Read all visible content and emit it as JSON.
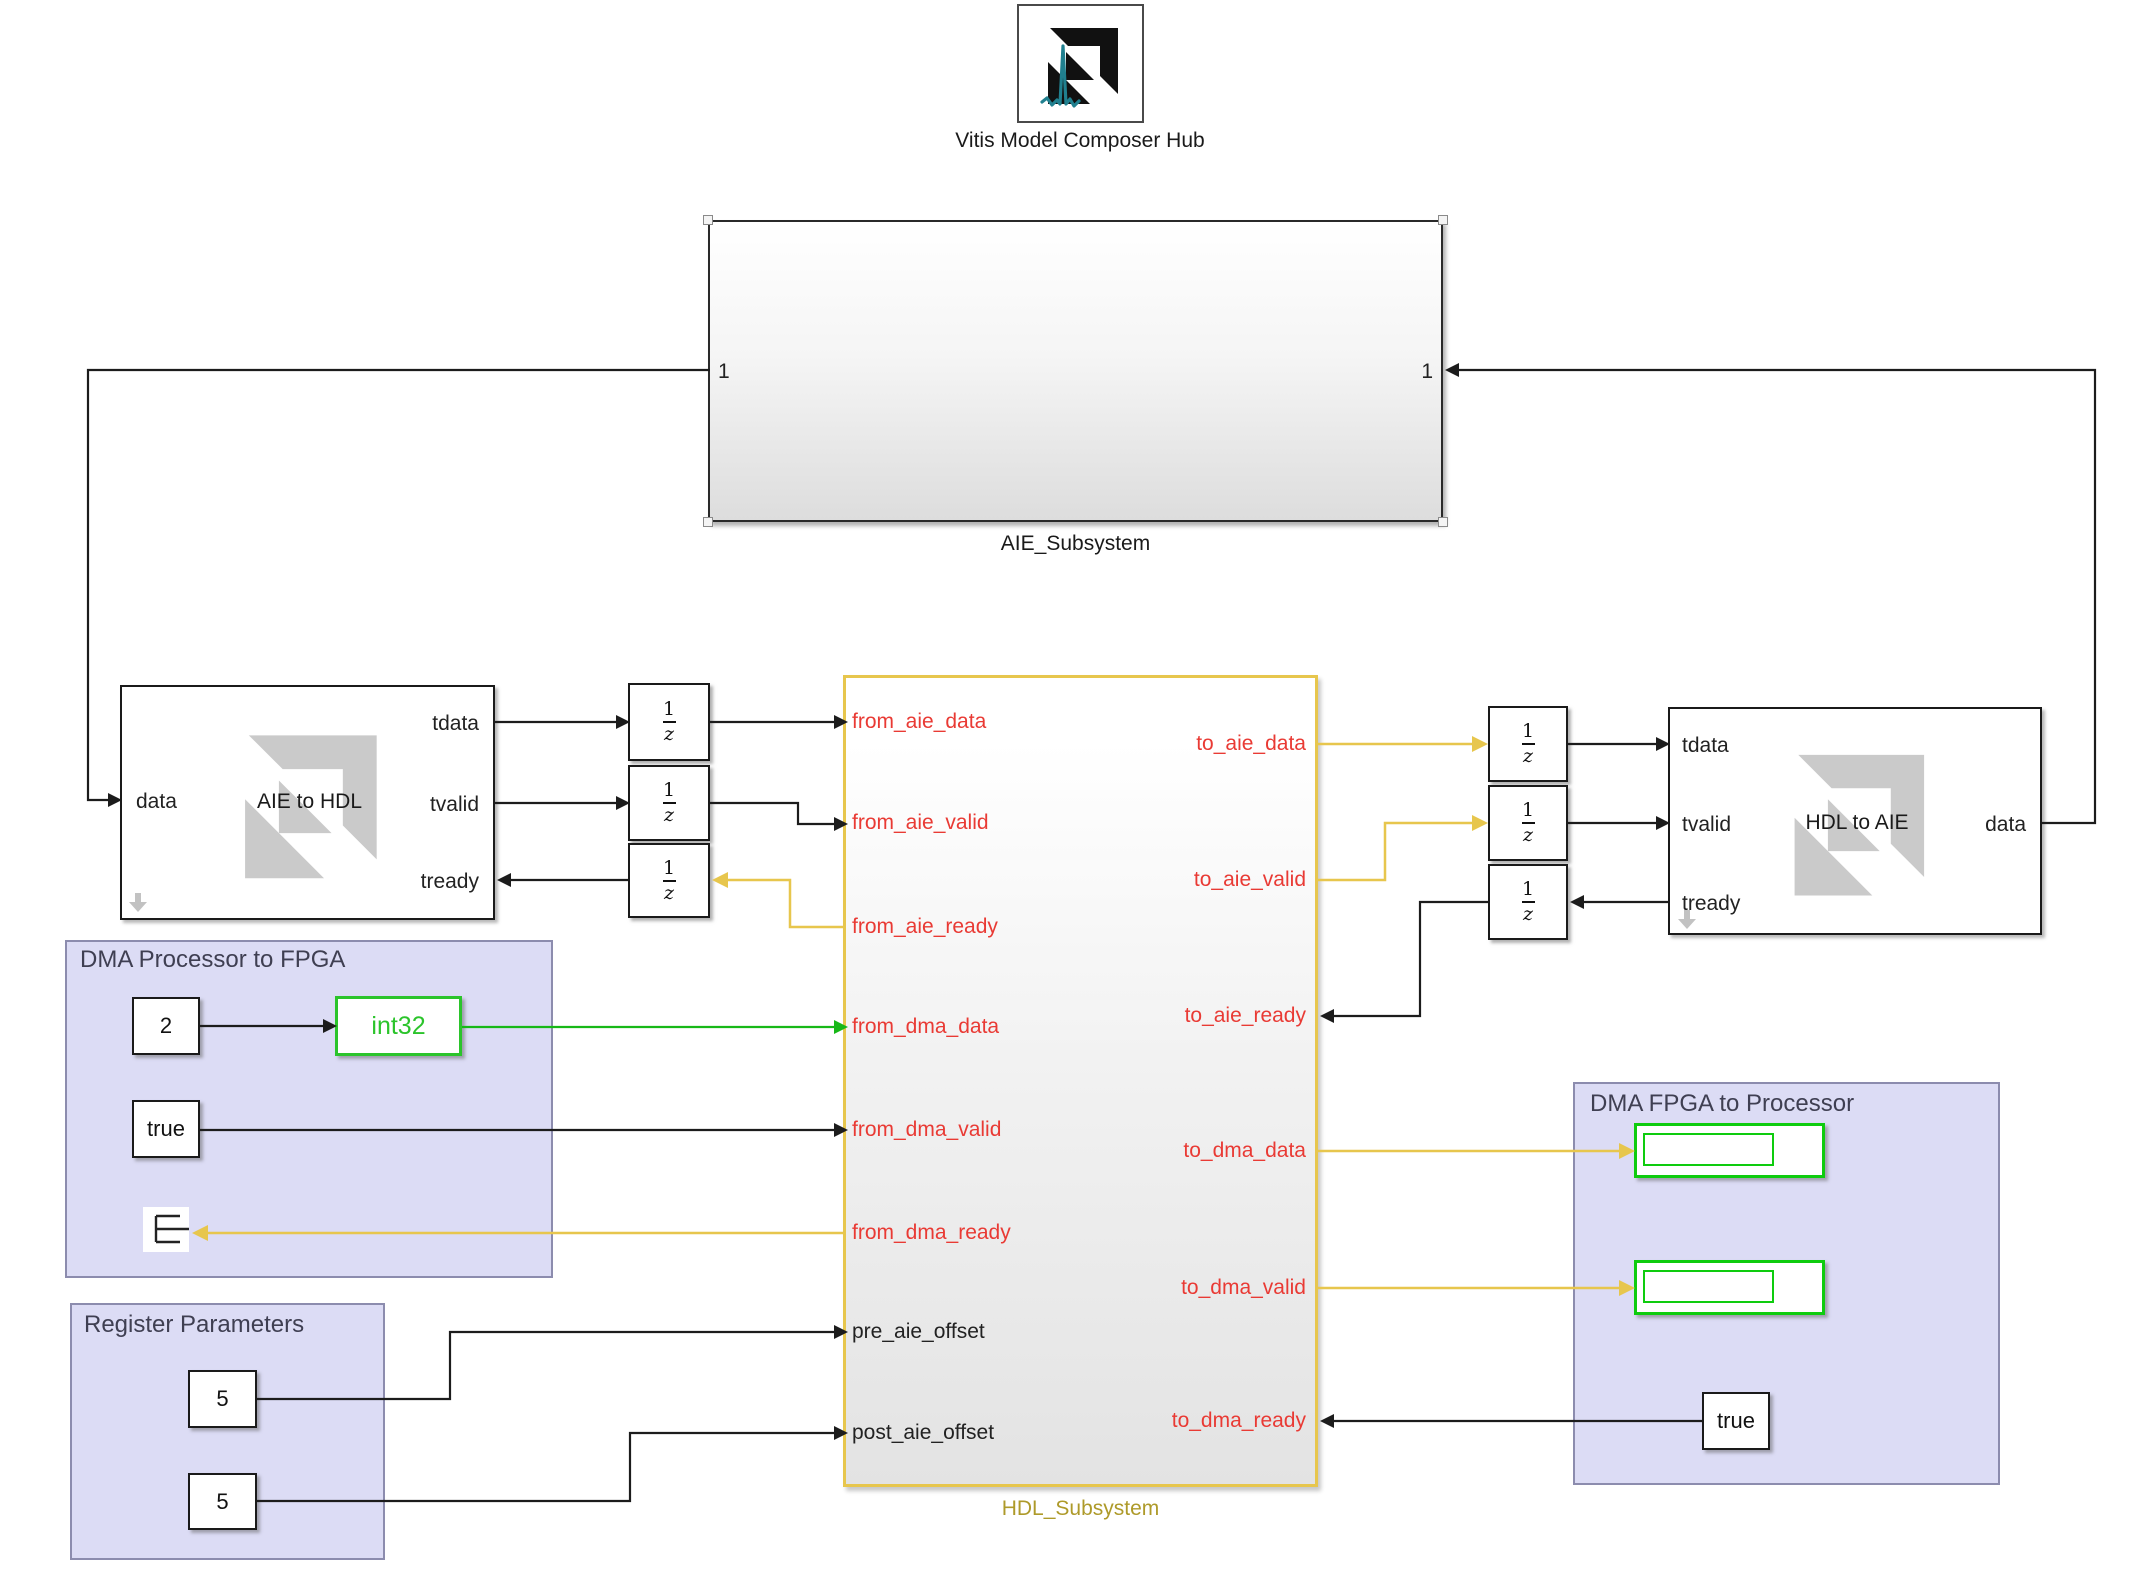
{
  "canvas": {
    "width": 2132,
    "height": 1570
  },
  "colors": {
    "wire_black": "#1c1c1c",
    "wire_yellow": "#e7c64d",
    "wire_green": "#17b817",
    "port_red": "#e93a34",
    "hdl_border_yellow": "#e7c64d",
    "hdl_label_olive": "#ae9a2a",
    "cast_green": "#2bc42b",
    "display_green": "#0ecc0e",
    "area_fill": "#dcdcf5",
    "area_border": "#8c8cae",
    "area_title_gray": "#3f3f52",
    "watermark_gray": "#cacaca",
    "logo_teal": "#20808f",
    "logo_black": "#111111"
  },
  "hub": {
    "label": "Vitis Model Composer Hub",
    "icon": "vitis-model-composer-hub-icon"
  },
  "aie_subsystem": {
    "label": "AIE_Subsystem",
    "left_port_number": "1",
    "right_port_number": "1"
  },
  "aie_to_hdl": {
    "title": "AIE to HDL",
    "port_data": "data",
    "port_tdata": "tdata",
    "port_tvalid": "tvalid",
    "port_tready": "tready",
    "watermark": "amd-arrow-watermark",
    "link_icon": "down-arrow-icon"
  },
  "hdl_to_aie": {
    "title": "HDL to AIE",
    "port_tdata": "tdata",
    "port_tvalid": "tvalid",
    "port_tready": "tready",
    "port_data": "data",
    "watermark": "amd-arrow-watermark",
    "link_icon": "down-arrow-icon"
  },
  "unit_delay": {
    "numerator": "1",
    "denominator": "z"
  },
  "hdl_subsystem": {
    "label": "HDL_Subsystem",
    "left_ports": [
      "from_aie_data",
      "from_aie_valid",
      "from_aie_ready",
      "from_dma_data",
      "from_dma_valid",
      "from_dma_ready",
      "pre_aie_offset",
      "post_aie_offset"
    ],
    "right_ports": [
      "to_aie_data",
      "to_aie_valid",
      "to_aie_ready",
      "to_dma_data",
      "to_dma_valid",
      "to_dma_ready"
    ]
  },
  "dma_processor_to_fpga": {
    "title": "DMA Processor to FPGA",
    "constant_value": "2",
    "cast_label": "int32",
    "valid_constant_value": "true",
    "terminator_icon": "terminator-icon"
  },
  "register_parameters": {
    "title": "Register Parameters",
    "pre_offset_value": "5",
    "post_offset_value": "5"
  },
  "dma_fpga_to_processor": {
    "title": "DMA FPGA to Processor",
    "ready_constant_value": "true"
  }
}
